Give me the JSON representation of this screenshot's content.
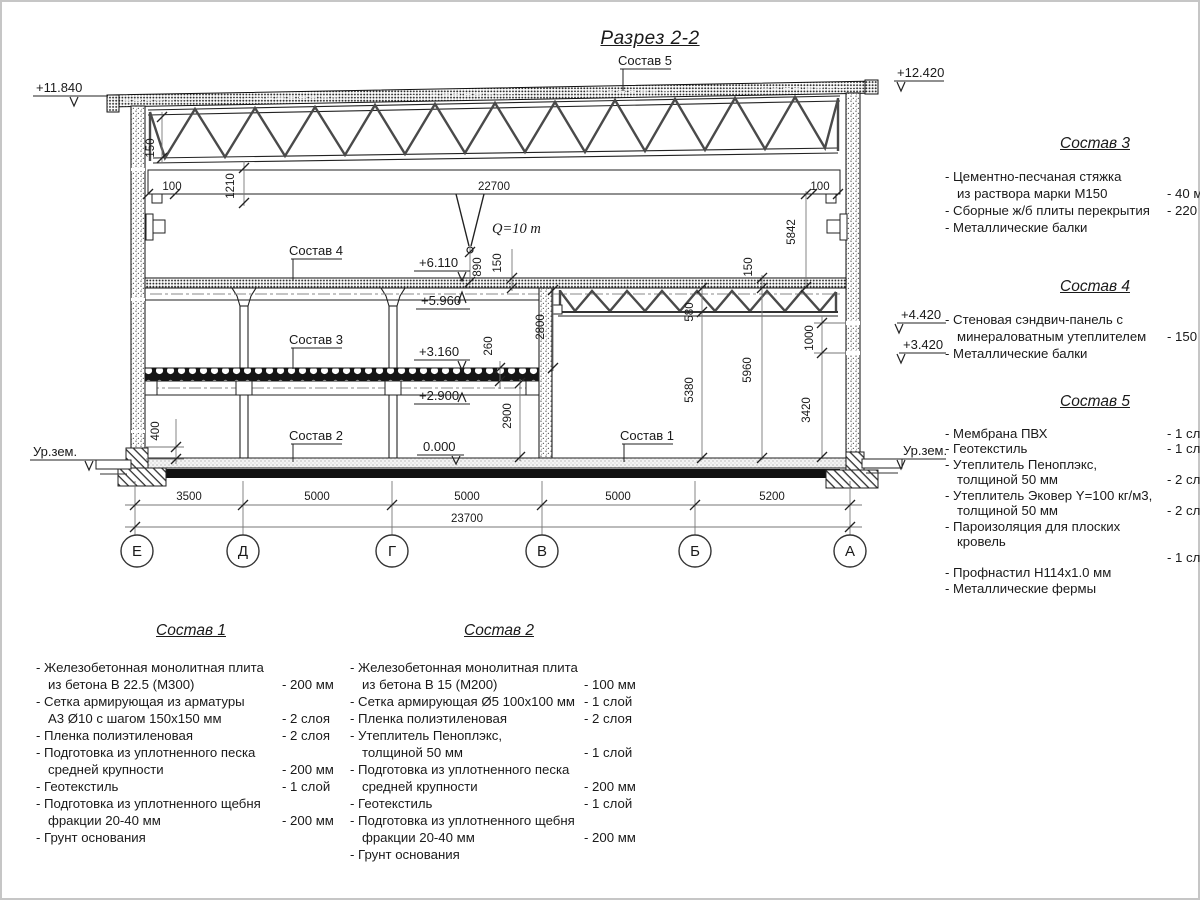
{
  "title": "Разрез 2-2",
  "drawing": {
    "callouts": {
      "c1": "Состав 1",
      "c2": "Состав 2",
      "c3": "Состав 3",
      "c4": "Состав 4",
      "c5": "Состав 5"
    },
    "crane_capacity": "Q=10 т",
    "elevations": {
      "roof_left": "+11.840",
      "roof_right": "+12.420",
      "wall_upper": "+4.420",
      "wall_lower": "+3.420",
      "ground_left": "Ур.зем.",
      "ground_right": "Ур.зем.",
      "mezz_top": "+6.110",
      "mezz_bottom": "+5.960",
      "floor2_top": "+3.160",
      "floor2_bottom": "+2.900",
      "floor_zero": "0.000"
    },
    "dims": {
      "t150": "150",
      "l100": "100",
      "v1210": "1210",
      "span22700": "22700",
      "r100": "100",
      "v890": "890",
      "m150": "150",
      "v5842": "5842",
      "v2800": "2800",
      "v260": "260",
      "v2900": "2900",
      "v400": "400",
      "v580": "580",
      "v5380": "5380",
      "rt150": "150",
      "v5960": "5960",
      "v1000": "1000",
      "v3420": "3420"
    },
    "bottom_dims": [
      "3500",
      "5000",
      "5000",
      "5000",
      "5200"
    ],
    "total_dim": "23700",
    "axes": [
      "Е",
      "Д",
      "Г",
      "В",
      "Б",
      "А"
    ]
  },
  "lists": {
    "comp1": {
      "title": "Состав 1",
      "items": [
        {
          "name": "- Железобетонная  монолитная плита\nиз бетона В 22.5 (М300)",
          "value": "- 200 мм"
        },
        {
          "name": "- Сетка армирующая из арматуры\nА3 Ø10 с шагом 150х150 мм",
          "value": "- 2 слоя"
        },
        {
          "name": "- Пленка полиэтиленовая",
          "value": "-  2 слоя"
        },
        {
          "name": "- Подготовка из уплотненного песка\nсредней крупности",
          "value": "- 200 мм"
        },
        {
          "name": "- Геотекстиль",
          "value": "- 1 слой"
        },
        {
          "name": "- Подготовка из уплотненного щебня\nфракции 20-40 мм",
          "value": "- 200 мм"
        },
        {
          "name": "- Грунт основания",
          "value": ""
        }
      ]
    },
    "comp2": {
      "title": "Состав 2",
      "items": [
        {
          "name": "- Железобетонная  монолитная плита\nиз бетона В 15 (М200)",
          "value": "- 100 мм"
        },
        {
          "name": "- Сетка армирующая Ø5 100х100 мм",
          "value": "- 1 слой"
        },
        {
          "name": "- Пленка полиэтиленовая",
          "value": "-  2 слоя"
        },
        {
          "name": "- Утеплитель Пеноплэкс,\nтолщиной 50 мм",
          "value": "- 1 слой"
        },
        {
          "name": "- Подготовка из уплотненного песка\nсредней крупности",
          "value": "- 200 мм"
        },
        {
          "name": "- Геотекстиль",
          "value": "- 1 слой"
        },
        {
          "name": "- Подготовка из уплотненного щебня\nфракции 20-40 мм",
          "value": "- 200 мм"
        },
        {
          "name": "- Грунт основания",
          "value": ""
        }
      ]
    },
    "comp3": {
      "title": "Состав 3",
      "items": [
        {
          "name": "- Цементно-песчаная стяжка\nиз раствора марки М150",
          "value": "- 40 мм"
        },
        {
          "name": "- Сборные ж/б плиты перекрытия",
          "value": "- 220 мм"
        },
        {
          "name": "- Металлические балки",
          "value": ""
        }
      ]
    },
    "comp4": {
      "title": "Состав 4",
      "items": [
        {
          "name": "- Стеновая сэндвич-панель с\nминераловатным утеплителем",
          "value": "- 150 мм"
        },
        {
          "name": "- Металлические балки",
          "value": ""
        }
      ]
    },
    "comp5": {
      "title": "Состав 5",
      "items": [
        {
          "name": "- Мембрана ПВХ",
          "value": "- 1 слой"
        },
        {
          "name": "- Геотекстиль",
          "value": "- 1 слой"
        },
        {
          "name": "- Утеплитель Пеноплэкс,\nтолщиной 50 мм",
          "value": "- 2 слоя"
        },
        {
          "name": "- Утеплитель Эковер Y=100 кг/м3,\nтолщиной 50 мм",
          "value": "- 2 слоя"
        },
        {
          "name": "- Пароизоляция для плоских кровель",
          "value": ""
        },
        {
          "name": "",
          "value": "- 1 слой"
        },
        {
          "name": "- Профнастил Н114х1.0 мм",
          "value": ""
        },
        {
          "name": "- Металлические фермы",
          "value": ""
        }
      ]
    }
  }
}
